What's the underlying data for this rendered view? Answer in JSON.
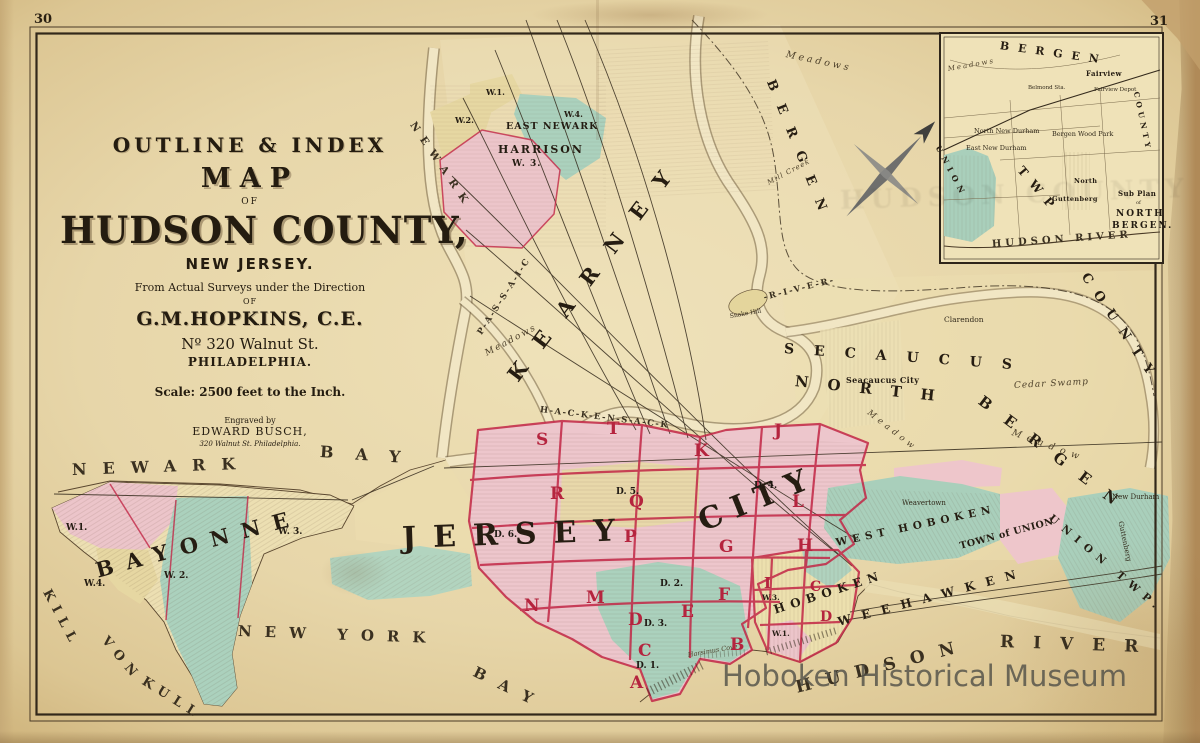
{
  "page": {
    "left_page_number": "30",
    "right_page_number": "31"
  },
  "watermark": {
    "text": "Hoboken Historical Museum"
  },
  "title_block": {
    "header": "OUTLINE & INDEX",
    "map": "MAP",
    "of1": "OF",
    "county": "HUDSON COUNTY,",
    "state": "NEW JERSEY.",
    "surveys": "From Actual Surveys under the Direction",
    "of2": "OF",
    "author": "G.M.HOPKINS, C.E.",
    "address": "Nº 320 Walnut St.",
    "city": "PHILADELPHIA.",
    "scale": "Scale: 2500 feet to the Inch.",
    "engraved_by": "Engraved by",
    "engraver": "EDWARD BUSCH,",
    "engraver_address": "320 Walnut St. Philadelphia."
  },
  "colors": {
    "paper": "#e6d5a8",
    "paper_dark": "#c8ab79",
    "pink_region": "#edc6cc",
    "green_region": "#abd1bd",
    "yellow_region": "#e8d9a8",
    "red_boundary": "#c22746",
    "ink": "#2e2517",
    "watermark_gray": "#524e48"
  },
  "map_labels": [
    {
      "n": "label-newark-bay-newark",
      "t": "NEWARK",
      "x": 72,
      "y": 462,
      "s": 16,
      "l": 16,
      "r": -2,
      "c": "water"
    },
    {
      "n": "label-newark-bay-bay",
      "t": "BAY",
      "x": 320,
      "y": 444,
      "s": 16,
      "l": 22,
      "r": 4,
      "c": "water"
    },
    {
      "n": "label-kill-von-kull-1",
      "t": "KILL",
      "x": 46,
      "y": 584,
      "s": 13,
      "l": 7,
      "r": 62,
      "c": "water"
    },
    {
      "n": "label-kill-von-kull-2",
      "t": "VON",
      "x": 104,
      "y": 632,
      "s": 13,
      "l": 7,
      "r": 50,
      "c": "water"
    },
    {
      "n": "label-kill-von-kull-3",
      "t": "KULL",
      "x": 143,
      "y": 674,
      "s": 13,
      "l": 7,
      "r": 32,
      "c": "water"
    },
    {
      "n": "label-new-york-bay-1",
      "t": "NEW YORK",
      "x": 238,
      "y": 624,
      "s": 15,
      "l": 13,
      "r": 2,
      "c": "water"
    },
    {
      "n": "label-new-york-bay-2",
      "t": "BAY",
      "x": 474,
      "y": 664,
      "s": 15,
      "l": 15,
      "r": 26,
      "c": "water"
    },
    {
      "n": "label-hudson-river-1",
      "t": "HUDSON",
      "x": 796,
      "y": 680,
      "s": 17,
      "l": 15,
      "r": -14,
      "c": "water"
    },
    {
      "n": "label-hudson-river-2",
      "t": "RIVER",
      "x": 1000,
      "y": 634,
      "s": 17,
      "l": 19,
      "r": 2,
      "c": "water"
    },
    {
      "n": "label-bayonne",
      "t": "BAYONNE",
      "x": 96,
      "y": 560,
      "s": 21,
      "l": 13,
      "r": -15,
      "c": "region"
    },
    {
      "n": "label-jersey",
      "t": "JERSEY",
      "x": 402,
      "y": 524,
      "s": 30,
      "l": 17,
      "r": -2,
      "c": "region"
    },
    {
      "n": "label-city",
      "t": "CITY",
      "x": 700,
      "y": 508,
      "s": 30,
      "l": 11,
      "r": -22,
      "c": "region"
    },
    {
      "n": "label-kearney",
      "t": "KEARNEY",
      "x": 512,
      "y": 368,
      "s": 21,
      "l": 23,
      "r": -53,
      "c": "region"
    },
    {
      "n": "label-secaucus",
      "t": "SECAUCUS",
      "x": 784,
      "y": 342,
      "s": 14,
      "l": 20,
      "r": 4,
      "c": "region"
    },
    {
      "n": "label-north",
      "t": "NORTH",
      "x": 795,
      "y": 374,
      "s": 15,
      "l": 19,
      "r": 6,
      "c": "region"
    },
    {
      "n": "label-bergen-lower",
      "t": "BERGEN",
      "x": 980,
      "y": 392,
      "s": 15,
      "l": 19,
      "r": 37,
      "c": "region"
    },
    {
      "n": "label-bergen-county-top",
      "t": "BERGEN",
      "x": 770,
      "y": 74,
      "s": 13,
      "l": 15,
      "r": 68,
      "c": "region"
    },
    {
      "n": "label-county-right",
      "t": "COUNTY",
      "x": 1084,
      "y": 268,
      "s": 13,
      "l": 11,
      "r": 56,
      "c": "region"
    },
    {
      "n": "label-weehawken",
      "t": "WEEHAWKEN",
      "x": 838,
      "y": 616,
      "s": 12,
      "l": 11,
      "r": -15,
      "c": "region"
    },
    {
      "n": "label-west-hoboken",
      "t": "WEST HOBOKEN",
      "x": 836,
      "y": 538,
      "s": 10.5,
      "l": 5,
      "r": -12,
      "c": "region"
    },
    {
      "n": "label-town-of-union",
      "t": "TOWN of UNION",
      "x": 960,
      "y": 542,
      "s": 9.5,
      "l": 0.5,
      "r": -15,
      "c": "place"
    },
    {
      "n": "label-union-twp",
      "t": "UNION TWP.",
      "x": 1050,
      "y": 512,
      "s": 10.5,
      "l": 7,
      "r": 40,
      "c": "region"
    },
    {
      "n": "label-hoboken",
      "t": "HOBOKEN",
      "x": 774,
      "y": 604,
      "s": 12,
      "l": 6,
      "r": -18,
      "c": "region"
    },
    {
      "n": "label-newark-vert",
      "t": "NEWARK",
      "x": 412,
      "y": 118,
      "s": 10.5,
      "l": 8,
      "r": 56,
      "c": "water"
    },
    {
      "n": "label-passaic-river",
      "t": "P-A-S-S-A-I-C",
      "x": 480,
      "y": 330,
      "s": 8.5,
      "l": 2,
      "r": -57,
      "c": "water"
    },
    {
      "n": "label-hackensack-river",
      "t": "H-A-C-K-E-N-S-A-C-K",
      "x": 540,
      "y": 406,
      "s": 8.5,
      "l": 1.5,
      "r": 7,
      "c": "water"
    },
    {
      "n": "label-river-dash",
      "t": "-R-I-V-E-R-",
      "x": 764,
      "y": 294,
      "s": 8.5,
      "l": 2,
      "r": -14,
      "c": "water"
    },
    {
      "n": "label-meadows-kearny",
      "t": "Meadows",
      "x": 486,
      "y": 350,
      "s": 9,
      "l": 2,
      "r": -28,
      "c": "script"
    },
    {
      "n": "label-meadows-top",
      "t": "Meadows",
      "x": 786,
      "y": 50,
      "s": 9.5,
      "l": 3,
      "r": 12,
      "c": "script"
    },
    {
      "n": "label-meadow-nb1",
      "t": "Meadow",
      "x": 1012,
      "y": 428,
      "s": 9.5,
      "l": 6,
      "r": 20,
      "c": "script"
    },
    {
      "n": "label-meadow-nb2",
      "t": "Meadow",
      "x": 868,
      "y": 408,
      "s": 8.5,
      "l": 4,
      "r": 38,
      "c": "script"
    },
    {
      "n": "label-cedar-swamp",
      "t": "Cedar Swamp",
      "x": 1014,
      "y": 382,
      "s": 9,
      "l": 1,
      "r": -3,
      "c": "script"
    },
    {
      "n": "label-mill-creek",
      "t": "Mill Creek",
      "x": 768,
      "y": 180,
      "s": 7,
      "l": 1,
      "r": -28,
      "c": "script"
    },
    {
      "n": "label-harsimus-cove",
      "t": "Harsimus Cove",
      "x": 688,
      "y": 652,
      "s": 6.5,
      "l": 0,
      "r": -10,
      "c": "script"
    },
    {
      "n": "label-harrison",
      "t": "HARRISON",
      "x": 498,
      "y": 144,
      "s": 11,
      "l": 2,
      "r": 0,
      "c": "place"
    },
    {
      "n": "label-harrison-w3",
      "t": "W. 3.",
      "x": 512,
      "y": 160,
      "s": 9,
      "l": 1,
      "r": 0,
      "c": "ward"
    },
    {
      "n": "label-east-newark",
      "t": "EAST NEWARK",
      "x": 506,
      "y": 122,
      "s": 9.5,
      "l": 1,
      "r": 0,
      "c": "place"
    },
    {
      "n": "label-harrison-w1",
      "t": "W.1.",
      "x": 486,
      "y": 88,
      "s": 8,
      "r": 0,
      "c": "ward"
    },
    {
      "n": "label-harrison-w2",
      "t": "W.2.",
      "x": 455,
      "y": 116,
      "s": 8,
      "r": 0,
      "c": "ward"
    },
    {
      "n": "label-harrison-w4",
      "t": "W.4.",
      "x": 564,
      "y": 110,
      "s": 8,
      "r": 0,
      "c": "ward"
    },
    {
      "n": "label-bayonne-w1",
      "t": "W.1.",
      "x": 66,
      "y": 524,
      "s": 9,
      "c": "ward"
    },
    {
      "n": "label-bayonne-w4",
      "t": "W.4.",
      "x": 84,
      "y": 580,
      "s": 9,
      "c": "ward"
    },
    {
      "n": "label-bayonne-w2",
      "t": "W. 2.",
      "x": 164,
      "y": 572,
      "s": 9,
      "c": "ward"
    },
    {
      "n": "label-bayonne-w3",
      "t": "W. 3.",
      "x": 278,
      "y": 528,
      "s": 9,
      "c": "ward"
    },
    {
      "n": "label-weavertown",
      "t": "Weavertown",
      "x": 902,
      "y": 500,
      "s": 7,
      "c": "placesm"
    },
    {
      "n": "label-new-durham",
      "t": "New Durham",
      "x": 1112,
      "y": 494,
      "s": 7,
      "c": "placesm"
    },
    {
      "n": "label-guttenberg-main",
      "t": "Guttenberg",
      "x": 1120,
      "y": 518,
      "s": 7,
      "r": 78,
      "c": "placesm"
    },
    {
      "n": "label-seacaucus-city",
      "t": "Seacaucus City",
      "x": 846,
      "y": 376,
      "s": 8,
      "c": "place"
    },
    {
      "n": "label-clarendon",
      "t": "Clarendon",
      "x": 944,
      "y": 316,
      "s": 7.5,
      "c": "placesm"
    },
    {
      "n": "label-snake-hill",
      "t": "Snake Hill",
      "x": 730,
      "y": 314,
      "s": 6,
      "r": -10,
      "c": "placesm"
    },
    {
      "n": "label-hoboken-w3",
      "t": "W.3.",
      "x": 762,
      "y": 594,
      "s": 7.5,
      "c": "ward"
    },
    {
      "n": "label-hoboken-w1",
      "t": "W.1.",
      "x": 772,
      "y": 630,
      "s": 7.5,
      "c": "ward"
    },
    {
      "n": "district-s",
      "t": "S",
      "x": 536,
      "y": 432,
      "s": 17,
      "c": "dletter"
    },
    {
      "n": "district-t",
      "t": "T",
      "x": 607,
      "y": 421,
      "s": 17,
      "c": "dletter"
    },
    {
      "n": "district-k",
      "t": "K",
      "x": 694,
      "y": 443,
      "s": 17,
      "c": "dletter"
    },
    {
      "n": "district-j",
      "t": "J",
      "x": 774,
      "y": 423,
      "s": 17,
      "c": "dletter"
    },
    {
      "n": "district-r",
      "t": "R",
      "x": 550,
      "y": 486,
      "s": 17,
      "c": "dletter"
    },
    {
      "n": "district-q",
      "t": "Q",
      "x": 629,
      "y": 494,
      "s": 17,
      "c": "dletter"
    },
    {
      "n": "district-l",
      "t": "L",
      "x": 792,
      "y": 494,
      "s": 17,
      "c": "dletter"
    },
    {
      "n": "district-p",
      "t": "P",
      "x": 624,
      "y": 529,
      "s": 17,
      "c": "dletter"
    },
    {
      "n": "district-g",
      "t": "G",
      "x": 719,
      "y": 539,
      "s": 17,
      "c": "dletter"
    },
    {
      "n": "district-h",
      "t": "H",
      "x": 797,
      "y": 538,
      "s": 17,
      "c": "dletter"
    },
    {
      "n": "district-i",
      "t": "I",
      "x": 764,
      "y": 576,
      "s": 15,
      "c": "dletter"
    },
    {
      "n": "district-n",
      "t": "N",
      "x": 524,
      "y": 598,
      "s": 17,
      "c": "dletter"
    },
    {
      "n": "district-m",
      "t": "M",
      "x": 586,
      "y": 590,
      "s": 17,
      "c": "dletter"
    },
    {
      "n": "district-d",
      "t": "D",
      "x": 628,
      "y": 612,
      "s": 17,
      "c": "dletter"
    },
    {
      "n": "district-e",
      "t": "E",
      "x": 681,
      "y": 604,
      "s": 17,
      "c": "dletter"
    },
    {
      "n": "district-f",
      "t": "F",
      "x": 718,
      "y": 587,
      "s": 17,
      "c": "dletter"
    },
    {
      "n": "district-c",
      "t": "C",
      "x": 638,
      "y": 643,
      "s": 17,
      "c": "dletter"
    },
    {
      "n": "district-b",
      "t": "B",
      "x": 730,
      "y": 637,
      "s": 17,
      "c": "dletter"
    },
    {
      "n": "district-a",
      "t": "A",
      "x": 630,
      "y": 675,
      "s": 17,
      "c": "dletter"
    },
    {
      "n": "district-hoboken-c",
      "t": "C",
      "x": 810,
      "y": 580,
      "s": 14,
      "c": "dletter"
    },
    {
      "n": "district-hoboken-d",
      "t": "D",
      "x": 820,
      "y": 610,
      "s": 14,
      "c": "dletter"
    },
    {
      "n": "district-d5",
      "t": "D. 5.",
      "x": 616,
      "y": 488,
      "s": 9,
      "c": "dnum"
    },
    {
      "n": "district-d6",
      "t": "D. 6.",
      "x": 494,
      "y": 531,
      "s": 9,
      "c": "dnum"
    },
    {
      "n": "district-d4",
      "t": "D. 4.",
      "x": 754,
      "y": 482,
      "s": 9,
      "c": "dnum"
    },
    {
      "n": "district-d2",
      "t": "D. 2.",
      "x": 660,
      "y": 580,
      "s": 9,
      "c": "dnum"
    },
    {
      "n": "district-d3",
      "t": "D. 3.",
      "x": 644,
      "y": 620,
      "s": 9,
      "c": "dnum"
    },
    {
      "n": "district-d1",
      "t": "D. 1.",
      "x": 636,
      "y": 662,
      "s": 9,
      "c": "dnum"
    },
    {
      "n": "inset-bergen",
      "t": "BERGEN",
      "x": 1000,
      "y": 40,
      "s": 11,
      "l": 9,
      "r": 8,
      "c": "region"
    },
    {
      "n": "inset-fairview",
      "t": "Fairview",
      "x": 1086,
      "y": 70,
      "s": 7,
      "c": "place"
    },
    {
      "n": "inset-fairview-depot",
      "t": "Fairview Depot",
      "x": 1094,
      "y": 88,
      "s": 5.5,
      "c": "placesm"
    },
    {
      "n": "inset-belmond-sta",
      "t": "Belmond Sta.",
      "x": 1028,
      "y": 86,
      "s": 5.5,
      "c": "placesm"
    },
    {
      "n": "inset-north-new-durham",
      "t": "North New Durham",
      "x": 974,
      "y": 128,
      "s": 6.5,
      "c": "placesm"
    },
    {
      "n": "inset-east-new-durham",
      "t": "East New Durham",
      "x": 966,
      "y": 145,
      "s": 6.5,
      "c": "placesm"
    },
    {
      "n": "inset-bergen-wood-park",
      "t": "Bergen Wood Park",
      "x": 1052,
      "y": 131,
      "s": 6.5,
      "c": "placesm"
    },
    {
      "n": "inset-north-label",
      "t": "North",
      "x": 1074,
      "y": 178,
      "s": 6.5,
      "c": "place"
    },
    {
      "n": "inset-guttenberg",
      "t": "Guttenberg",
      "x": 1052,
      "y": 196,
      "s": 6.5,
      "c": "place"
    },
    {
      "n": "inset-sub-plan",
      "t": "Sub Plan",
      "x": 1118,
      "y": 190,
      "s": 7,
      "c": "place"
    },
    {
      "n": "inset-of",
      "t": "of",
      "x": 1136,
      "y": 201,
      "s": 5,
      "c": "placesm"
    },
    {
      "n": "inset-north-bergen-1",
      "t": "NORTH",
      "x": 1116,
      "y": 210,
      "s": 9,
      "l": 2,
      "c": "place"
    },
    {
      "n": "inset-north-bergen-2",
      "t": "BERGEN.",
      "x": 1112,
      "y": 222,
      "s": 9,
      "l": 2,
      "c": "place"
    },
    {
      "n": "inset-union",
      "t": "UNION",
      "x": 938,
      "y": 142,
      "s": 8,
      "l": 5,
      "r": 62,
      "c": "region"
    },
    {
      "n": "inset-twp",
      "t": "TWP",
      "x": 1020,
      "y": 162,
      "s": 12,
      "l": 9,
      "r": 50,
      "c": "region"
    },
    {
      "n": "inset-hudson-river",
      "t": "HUDSON RIVER",
      "x": 992,
      "y": 240,
      "s": 10,
      "l": 4,
      "r": -4,
      "c": "water"
    },
    {
      "n": "inset-county",
      "t": "COUNTY",
      "x": 1136,
      "y": 88,
      "s": 7.5,
      "l": 4,
      "r": 78,
      "c": "region"
    },
    {
      "n": "inset-meadows",
      "t": "Meadows",
      "x": 948,
      "y": 66,
      "s": 7,
      "l": 2,
      "r": -10,
      "c": "script"
    },
    {
      "n": "ghost-showthrough",
      "t": "HUDSON COUNTY",
      "x": 840,
      "y": 188,
      "s": 26,
      "l": 6,
      "r": -2,
      "c": "ghost"
    }
  ]
}
